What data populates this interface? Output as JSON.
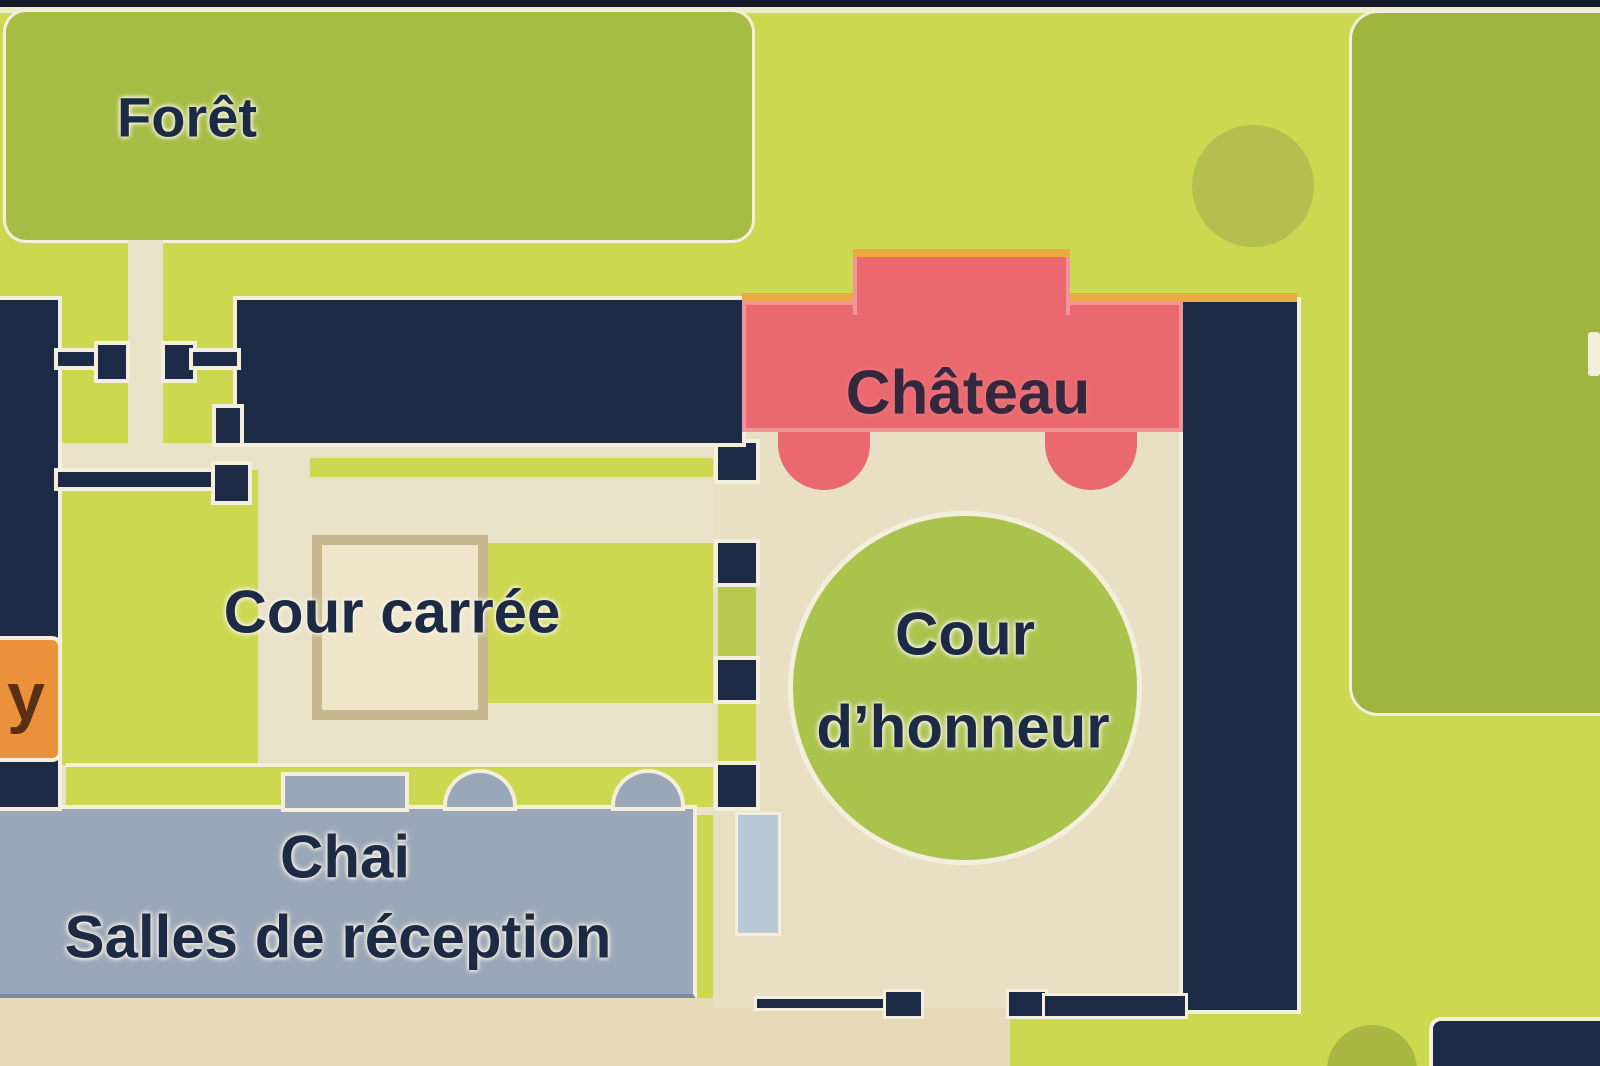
{
  "map": {
    "title": "Plan du domaine (château estate map)",
    "labels": {
      "foret": "Forêt",
      "chateau": "Château",
      "cour_carree": "Cour carrée",
      "cour_honneur_line1": "Cour",
      "cour_honneur_line2": "d’honneur",
      "chai_line1": "Chai",
      "chai_line2": "Salles de réception",
      "partial_left": "y"
    },
    "regions": [
      {
        "name": "foret",
        "type": "forest",
        "color_key": "foret"
      },
      {
        "name": "chateau",
        "type": "building",
        "color_key": "pink"
      },
      {
        "name": "cour-carree",
        "type": "courtyard",
        "color_key": "bg"
      },
      {
        "name": "cour-honneur",
        "type": "courtyard",
        "color_key": "circle_green"
      },
      {
        "name": "chai-salles-de-reception",
        "type": "building",
        "color_key": "chai"
      }
    ]
  },
  "colors": {
    "bg": "#ccd850",
    "navy": "#1e2b47",
    "navy_dark": "#141b2b",
    "pale": "#f4efdc",
    "foret": "#a7bc45",
    "green_right": "#a0b540",
    "circle_tr": "#b3bf4e",
    "circle_br": "#a9b743",
    "cream": "#eae1c9",
    "courtyard": "#e9dfc5",
    "beige": "#e6d9b8",
    "square_fill": "#efe5cb",
    "square_border": "#c8b88f",
    "pink": "#ea696f",
    "pink_light": "#f2959a",
    "orange_line": "#edaa44",
    "orange_label": "#ec913b",
    "label_letter": "#5a3015",
    "chai": "#9aa7b8",
    "chai_edge": "#7c8a9c",
    "circle_green": "#a9c34d",
    "olive_strip": "#b7c94f",
    "light_blue": "#bac7d4",
    "text": "#1d2a45",
    "chateau_text": "#35283c"
  }
}
